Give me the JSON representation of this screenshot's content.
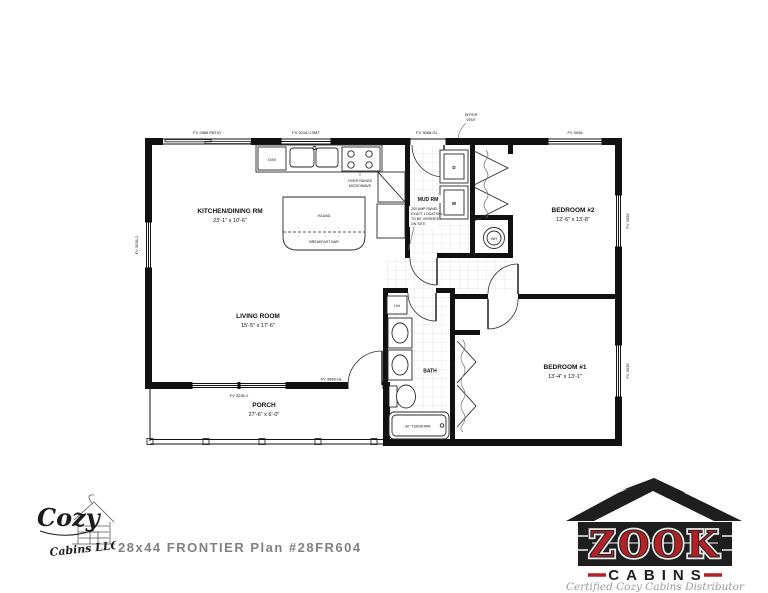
{
  "caption": {
    "text": "28x44 FRONTIER  Plan #28FR604"
  },
  "plan": {
    "rooms": {
      "kitchen": {
        "name": "KITCHEN/DINING RM",
        "dims": "23'-1\" x 10'-6\""
      },
      "living": {
        "name": "LIVING ROOM",
        "dims": "15'-5\" x 17'-6\""
      },
      "bedroom2": {
        "name": "BEDROOM #2",
        "dims": "12'-6\" x 13'-8\""
      },
      "bedroom1": {
        "name": "BEDROOM #1",
        "dims": "13'-4\" x 13'-1\""
      },
      "porch": {
        "name": "PORCH",
        "dims": "27'-6\" x 6'-0\""
      },
      "mudroom": {
        "name": "MUD RM"
      },
      "bath": {
        "name": "BATH"
      }
    },
    "fixtures": {
      "island": "ISLAND",
      "breakfast_bar": "BREAKFAST BAR",
      "dishwasher": "D/W",
      "dryer": "D",
      "washer": "W",
      "water_heater": "WH",
      "tub": "60\" TUB/SHWR",
      "linen": "LIN"
    },
    "notes": {
      "microwave": [
        "OVER RANGE",
        "MICROWAVE"
      ],
      "dryer_vent": [
        "DRYER",
        "VENT"
      ],
      "panel": [
        "200 AMP PANEL",
        "EXACT LOCATION",
        "TO BE VERIFIED",
        "ON SITE"
      ]
    },
    "openings": {
      "patio_door": "FV 2868 PATIO",
      "kitchen_window": "FV 3016 CSMT",
      "rear_door": "FV 3068-GL",
      "bedroom2_window": "FV 3036",
      "right_window_top": "FV 3036",
      "right_window_bottom": "FV 3036",
      "left_window": "FV 3036-2",
      "living_window": "FV 3036-2",
      "front_door": "FV 3068-GL"
    }
  },
  "branding": {
    "cozy": {
      "script_top": "Cozy",
      "script_bottom": "Cabins LLC"
    },
    "zook": {
      "name": "ZOOK",
      "sub": "CABINS",
      "tagline": "Certified Cozy Cabins Distributor",
      "red": "#b32025",
      "black": "#1e1e1e",
      "gray": "#9b9b9b"
    }
  }
}
